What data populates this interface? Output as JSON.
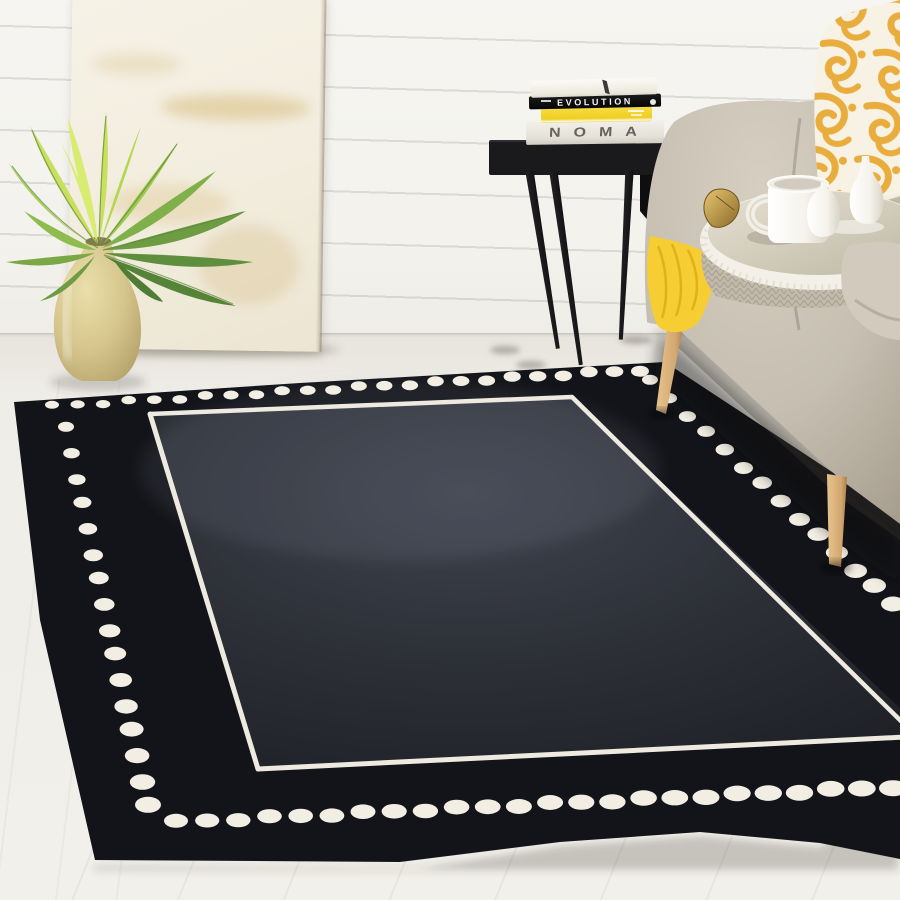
{
  "scene_title": "Living room with black area rug with ivory dotted border",
  "wall": {
    "color": "#f4f3ef",
    "plank_line_color": "#dcd9d1",
    "style": "white shiplap"
  },
  "floor": {
    "color": "#efede7",
    "style": "light wood planks"
  },
  "artwork": {
    "type": "leaning abstract canvas",
    "base_color": "#f4f0e4",
    "accent_color": "#d3af63"
  },
  "plant": {
    "type": "fern",
    "pot_color": "#d9c88f",
    "leaf_colors": [
      "#d9ec72",
      "#c9e05e",
      "#a8cd52",
      "#7fb04a",
      "#5f8f3e"
    ]
  },
  "side_table": {
    "color": "#17171a",
    "books": [
      {
        "title": "",
        "cover_color": "#f6f4ee"
      },
      {
        "title": "EVOLUTION",
        "cover_color": "#101010",
        "text_color": "#f5f5f3"
      },
      {
        "title": "",
        "cover_color": "#f2d62e"
      },
      {
        "title": "NOMA",
        "cover_color": "#e9e6df",
        "text_color": "#67635c"
      }
    ]
  },
  "sofa": {
    "fabric_color": "#c8c1b3",
    "wood_leg_color": "#d9b17c"
  },
  "pillow": {
    "base_color": "#f7f2e4",
    "pattern_color": "#e9ad3e",
    "style": "yellow damask scroll"
  },
  "throw_blanket": {
    "color": "#f6cd33"
  },
  "knit_blanket": {
    "color": "#c2bbac"
  },
  "tray": {
    "rim_color": "#f3f0e8",
    "mirror_color": "#d5cfc0",
    "handle_color": "#c29a44",
    "items": [
      "mug",
      "salt-shaker",
      "bud-vase"
    ]
  },
  "rug": {
    "style": "black wool rug, ivory dotted border with inner line",
    "field_color": "#32353d",
    "border_color": "#131419",
    "dot_color": "#f2eee3",
    "line_color": "#eeeae0"
  }
}
